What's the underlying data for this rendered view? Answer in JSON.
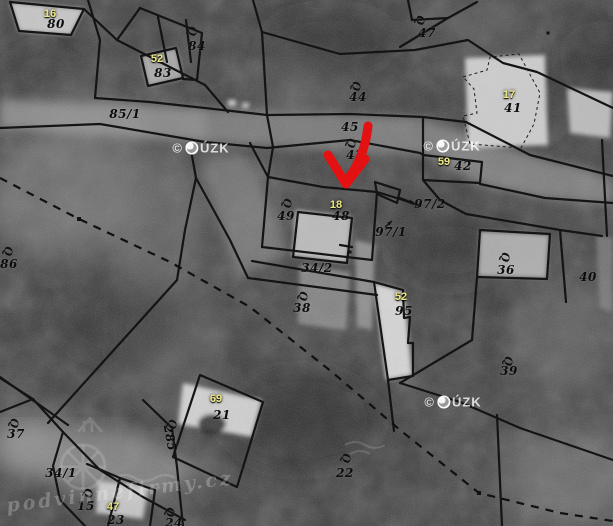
{
  "map": {
    "watermark_cuzk": "© ČÚZK",
    "watermark_cuzk_positions": [
      {
        "x": 201,
        "y": 148
      },
      {
        "x": 452,
        "y": 146
      },
      {
        "x": 453,
        "y": 402
      }
    ],
    "watermark_site": "podvinnefirmy.cz",
    "watermark_site_pos": {
      "x": 120,
      "y": 492
    },
    "colors": {
      "red_arrow": "#e31111",
      "yellow_label": "#ece87f",
      "black_label": "#0c0c0c",
      "boundary_line": "#141414"
    },
    "parcel_labels": [
      {
        "t": "80",
        "x": 56,
        "y": 24
      },
      {
        "t": "84",
        "x": 197,
        "y": 46
      },
      {
        "t": "83",
        "x": 163,
        "y": 73
      },
      {
        "t": "85/1",
        "x": 125,
        "y": 114
      },
      {
        "t": "44",
        "x": 358,
        "y": 97
      },
      {
        "t": "45",
        "x": 350,
        "y": 127
      },
      {
        "t": "43",
        "x": 355,
        "y": 155
      },
      {
        "t": "47",
        "x": 427,
        "y": 33
      },
      {
        "t": "41",
        "x": 513,
        "y": 108
      },
      {
        "t": "42",
        "x": 463,
        "y": 166
      },
      {
        "t": "97/2",
        "x": 430,
        "y": 204
      },
      {
        "t": "97/1",
        "x": 391,
        "y": 232
      },
      {
        "t": "49",
        "x": 286,
        "y": 216
      },
      {
        "t": "48",
        "x": 341,
        "y": 216
      },
      {
        "t": "86",
        "x": 9,
        "y": 264
      },
      {
        "t": "34/2",
        "x": 317,
        "y": 268
      },
      {
        "t": "38",
        "x": 302,
        "y": 308
      },
      {
        "t": "95",
        "x": 404,
        "y": 311
      },
      {
        "t": "36",
        "x": 506,
        "y": 270
      },
      {
        "t": "40",
        "x": 588,
        "y": 277
      },
      {
        "t": "39",
        "x": 509,
        "y": 371
      },
      {
        "t": "21",
        "x": 222,
        "y": 415
      },
      {
        "t": "37",
        "x": 16,
        "y": 434
      },
      {
        "t": "34/1",
        "x": 61,
        "y": 473
      },
      {
        "t": "15",
        "x": 86,
        "y": 506
      },
      {
        "t": "23",
        "x": 116,
        "y": 520
      },
      {
        "t": "22",
        "x": 345,
        "y": 473
      },
      {
        "t": "24",
        "x": 174,
        "y": 523
      },
      {
        "t": "285",
        "x": 170,
        "y": 438,
        "rot": 80
      }
    ],
    "building_labels": [
      {
        "t": "16",
        "x": 50,
        "y": 14
      },
      {
        "t": "52",
        "x": 157,
        "y": 59
      },
      {
        "t": "17",
        "x": 509,
        "y": 95
      },
      {
        "t": "59",
        "x": 444,
        "y": 162
      },
      {
        "t": "18",
        "x": 336,
        "y": 205
      },
      {
        "t": "52",
        "x": 401,
        "y": 297
      },
      {
        "t": "69",
        "x": 216,
        "y": 399
      },
      {
        "t": "47",
        "x": 113,
        "y": 507
      }
    ],
    "landuse_symbols": [
      {
        "x": 192,
        "y": 31
      },
      {
        "x": 420,
        "y": 20
      },
      {
        "x": 356,
        "y": 86
      },
      {
        "x": 351,
        "y": 143
      },
      {
        "x": 287,
        "y": 203
      },
      {
        "x": 8,
        "y": 251
      },
      {
        "x": 303,
        "y": 296
      },
      {
        "x": 505,
        "y": 257
      },
      {
        "x": 346,
        "y": 458
      },
      {
        "x": 508,
        "y": 361
      },
      {
        "x": 14,
        "y": 423
      },
      {
        "x": 88,
        "y": 493
      },
      {
        "x": 170,
        "y": 512
      },
      {
        "x": 172,
        "y": 424
      }
    ],
    "lines": {
      "solid": [
        [
          [
            88,
            0
          ],
          [
            100,
            40
          ],
          [
            95,
            98
          ]
        ],
        [
          [
            10,
            2
          ],
          [
            84,
            9
          ],
          [
            117,
            40
          ],
          [
            205,
            85
          ],
          [
            228,
            112
          ]
        ],
        [
          [
            84,
            9
          ],
          [
            71,
            35
          ],
          [
            19,
            31
          ],
          [
            10,
            2
          ]
        ],
        [
          [
            117,
            40
          ],
          [
            140,
            8
          ]
        ],
        [
          [
            140,
            8
          ],
          [
            202,
            33
          ],
          [
            197,
            80
          ],
          [
            183,
            79
          ]
        ],
        [
          [
            141,
            56
          ],
          [
            176,
            48
          ],
          [
            183,
            78
          ],
          [
            148,
            86
          ],
          [
            141,
            56
          ]
        ],
        [
          [
            158,
            17
          ],
          [
            167,
            62
          ]
        ],
        [
          [
            186,
            20
          ],
          [
            191,
            62
          ]
        ],
        [
          [
            95,
            98
          ],
          [
            150,
            102
          ],
          [
            205,
            108
          ],
          [
            267,
            115
          ]
        ],
        [
          [
            0,
            128
          ],
          [
            100,
            124
          ],
          [
            205,
            142
          ],
          [
            267,
            148
          ]
        ],
        [
          [
            253,
            0
          ],
          [
            262,
            32
          ],
          [
            267,
            115
          ],
          [
            273,
            147
          ],
          [
            268,
            177
          ]
        ],
        [
          [
            262,
            32
          ],
          [
            340,
            54
          ],
          [
            415,
            50
          ],
          [
            468,
            40
          ],
          [
            503,
            63
          ],
          [
            537,
            72
          ],
          [
            613,
            108
          ]
        ],
        [
          [
            408,
            0
          ],
          [
            412,
            20
          ],
          [
            448,
            18
          ]
        ],
        [
          [
            400,
            47
          ],
          [
            448,
            18
          ],
          [
            477,
            2
          ]
        ],
        [
          [
            267,
            115
          ],
          [
            350,
            114
          ],
          [
            423,
            117
          ],
          [
            466,
            122
          ]
        ],
        [
          [
            267,
            148
          ],
          [
            350,
            140
          ],
          [
            420,
            153
          ],
          [
            423,
            155
          ]
        ],
        [
          [
            466,
            122
          ],
          [
            530,
            155
          ],
          [
            613,
            176
          ]
        ],
        [
          [
            423,
            155
          ],
          [
            482,
            162
          ],
          [
            480,
            183
          ],
          [
            423,
            180
          ],
          [
            423,
            155
          ]
        ],
        [
          [
            423,
            117
          ],
          [
            423,
            155
          ]
        ],
        [
          [
            480,
            184
          ],
          [
            545,
            198
          ],
          [
            613,
            203
          ]
        ],
        [
          [
            250,
            143
          ],
          [
            268,
            177
          ]
        ],
        [
          [
            268,
            177
          ],
          [
            323,
            187
          ],
          [
            377,
            192
          ],
          [
            400,
            199
          ],
          [
            420,
            206
          ]
        ],
        [
          [
            375,
            182
          ],
          [
            400,
            190
          ],
          [
            397,
            203
          ],
          [
            377,
            194
          ],
          [
            375,
            182
          ]
        ],
        [
          [
            268,
            177
          ],
          [
            262,
            247
          ],
          [
            372,
            260
          ],
          [
            377,
            192
          ]
        ],
        [
          [
            298,
            212
          ],
          [
            352,
            218
          ],
          [
            347,
            263
          ],
          [
            293,
            257
          ],
          [
            298,
            212
          ]
        ],
        [
          [
            340,
            245
          ],
          [
            352,
            247
          ]
        ],
        [
          [
            252,
            261
          ],
          [
            374,
            282
          ]
        ],
        [
          [
            248,
            278
          ],
          [
            377,
            295
          ]
        ],
        [
          [
            374,
            282
          ],
          [
            403,
            290
          ],
          [
            404,
            318
          ],
          [
            410,
            317
          ],
          [
            408,
            343
          ],
          [
            413,
            343
          ],
          [
            413,
            376
          ],
          [
            388,
            380
          ],
          [
            374,
            282
          ]
        ],
        [
          [
            190,
            145
          ],
          [
            196,
            178
          ],
          [
            230,
            240
          ],
          [
            248,
            278
          ]
        ],
        [
          [
            196,
            178
          ],
          [
            185,
            230
          ],
          [
            177,
            280
          ]
        ],
        [
          [
            177,
            280
          ],
          [
            48,
            423
          ]
        ],
        [
          [
            0,
            377
          ],
          [
            68,
            425
          ]
        ],
        [
          [
            33,
            399
          ],
          [
            63,
            432
          ],
          [
            100,
            470
          ],
          [
            143,
            497
          ],
          [
            185,
            520
          ]
        ],
        [
          [
            0,
            378
          ],
          [
            33,
            399
          ],
          [
            0,
            412
          ]
        ],
        [
          [
            63,
            432
          ],
          [
            53,
            466
          ],
          [
            60,
            500
          ],
          [
            85,
            526
          ]
        ],
        [
          [
            87,
            464
          ],
          [
            120,
            478
          ],
          [
            155,
            490
          ],
          [
            150,
            526
          ]
        ],
        [
          [
            120,
            478
          ],
          [
            108,
            526
          ]
        ],
        [
          [
            143,
            400
          ],
          [
            172,
            428
          ],
          [
            177,
            467
          ],
          [
            183,
            526
          ]
        ],
        [
          [
            200,
            375
          ],
          [
            263,
            402
          ],
          [
            237,
            487
          ],
          [
            173,
            457
          ],
          [
            200,
            375
          ]
        ],
        [
          [
            400,
            383
          ],
          [
            460,
            402
          ],
          [
            520,
            428
          ],
          [
            613,
            460
          ]
        ],
        [
          [
            472,
            340
          ],
          [
            400,
            383
          ]
        ],
        [
          [
            497,
            415
          ],
          [
            502,
            526
          ]
        ],
        [
          [
            388,
            380
          ],
          [
            394,
            431
          ]
        ],
        [
          [
            466,
            214
          ],
          [
            560,
            230
          ],
          [
            602,
            236
          ]
        ],
        [
          [
            423,
            180
          ],
          [
            440,
            200
          ],
          [
            466,
            214
          ]
        ],
        [
          [
            480,
            230
          ],
          [
            550,
            234
          ],
          [
            547,
            279
          ],
          [
            477,
            277
          ],
          [
            480,
            230
          ]
        ],
        [
          [
            602,
            140
          ],
          [
            607,
            236
          ]
        ],
        [
          [
            560,
            230
          ],
          [
            566,
            302
          ]
        ],
        [
          [
            477,
            277
          ],
          [
            472,
            340
          ]
        ]
      ],
      "dashed": [
        [
          [
            0,
            178
          ],
          [
            79,
            219
          ],
          [
            170,
            262
          ],
          [
            250,
            307
          ],
          [
            332,
            372
          ],
          [
            400,
            430
          ],
          [
            479,
            493
          ],
          [
            560,
            513
          ],
          [
            613,
            521
          ]
        ]
      ],
      "thin_dashed": [
        [
          [
            463,
            77
          ],
          [
            487,
            70
          ],
          [
            490,
            57
          ],
          [
            519,
            54
          ],
          [
            540,
            93
          ],
          [
            534,
            124
          ],
          [
            521,
            148
          ],
          [
            470,
            144
          ],
          [
            463,
            116
          ],
          [
            477,
            113
          ],
          [
            474,
            89
          ],
          [
            463,
            77
          ]
        ]
      ],
      "nodes": [
        {
          "x": 79,
          "y": 219,
          "s": 4
        },
        {
          "x": 479,
          "y": 493,
          "s": 4
        },
        {
          "x": 350,
          "y": 252,
          "s": 3
        },
        {
          "x": 548,
          "y": 33,
          "s": 3
        }
      ],
      "ref_arrows": [
        {
          "x1": 398,
          "y1": 197,
          "x2": 414,
          "y2": 203
        },
        {
          "x1": 385,
          "y1": 227,
          "x2": 392,
          "y2": 221
        }
      ]
    }
  }
}
